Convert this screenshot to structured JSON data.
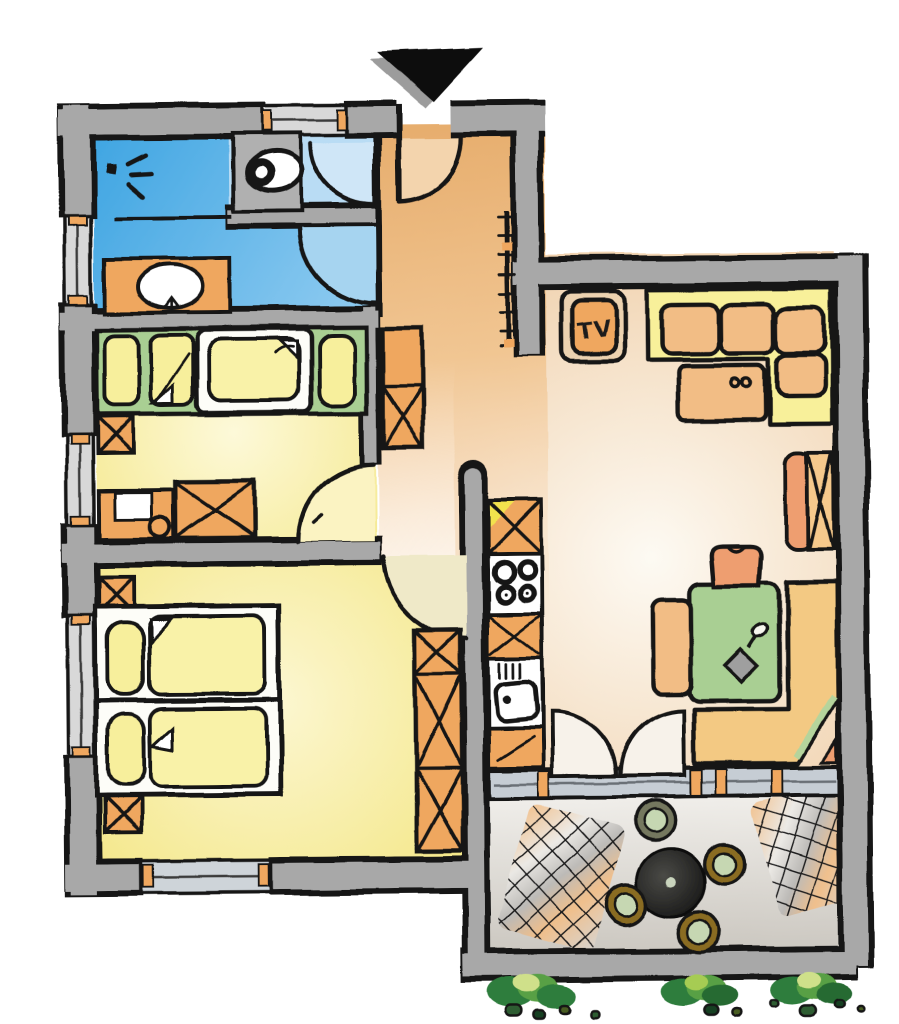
{
  "labels": {
    "tv": "TV"
  },
  "palette": {
    "ink": "#141414",
    "wall_gray": "#a8a8a8",
    "wall_edge": "#131313",
    "bath_blue": "#45a8e4",
    "wc_blue": "#b9dcf4",
    "hall_peach": "#e7ae6e",
    "room_yellow": "#f3e57f",
    "furniture_green": "#a9cf93",
    "cabinet_orange": "#efa75e",
    "cushion_orange": "#f2bd85",
    "sofa_yellow": "#f8f09a",
    "bench_tan": "#f3c983",
    "salmon": "#ee9e70",
    "glass_gray": "#c6cdd4",
    "balcony_gray": "#ddd9d4",
    "table_black": "#1a1a1a",
    "chair_gold": "#8a6c20",
    "chair_seat_green": "#c6d7b2",
    "plant_dark": "#2e7d3c",
    "plant_light": "#8bc34a",
    "paper_white": "#ffffff"
  },
  "entrance_marker": "black-arrow-down",
  "rooms": [
    {
      "id": "bathroom",
      "features": [
        "shower",
        "washbasin",
        "window"
      ]
    },
    {
      "id": "wc",
      "features": [
        "toilet"
      ]
    },
    {
      "id": "hallway",
      "features": [
        "entrance-door",
        "radiator",
        "cabinet"
      ]
    },
    {
      "id": "kids-room",
      "features": [
        "beds",
        "desk",
        "wardrobe",
        "window"
      ]
    },
    {
      "id": "bedroom",
      "features": [
        "double-bed",
        "nightstands",
        "wardrobe",
        "windows"
      ]
    },
    {
      "id": "kitchenette",
      "features": [
        "cooktop",
        "sink",
        "cabinets"
      ]
    },
    {
      "id": "living-room",
      "features": [
        "tv-cabinet",
        "sofa",
        "coffee-table",
        "sideboard"
      ]
    },
    {
      "id": "dining-area",
      "features": [
        "table",
        "corner-bench",
        "chairs"
      ]
    },
    {
      "id": "balcony",
      "features": [
        "round-table",
        "chairs",
        "sun-loungers",
        "plants"
      ]
    }
  ]
}
